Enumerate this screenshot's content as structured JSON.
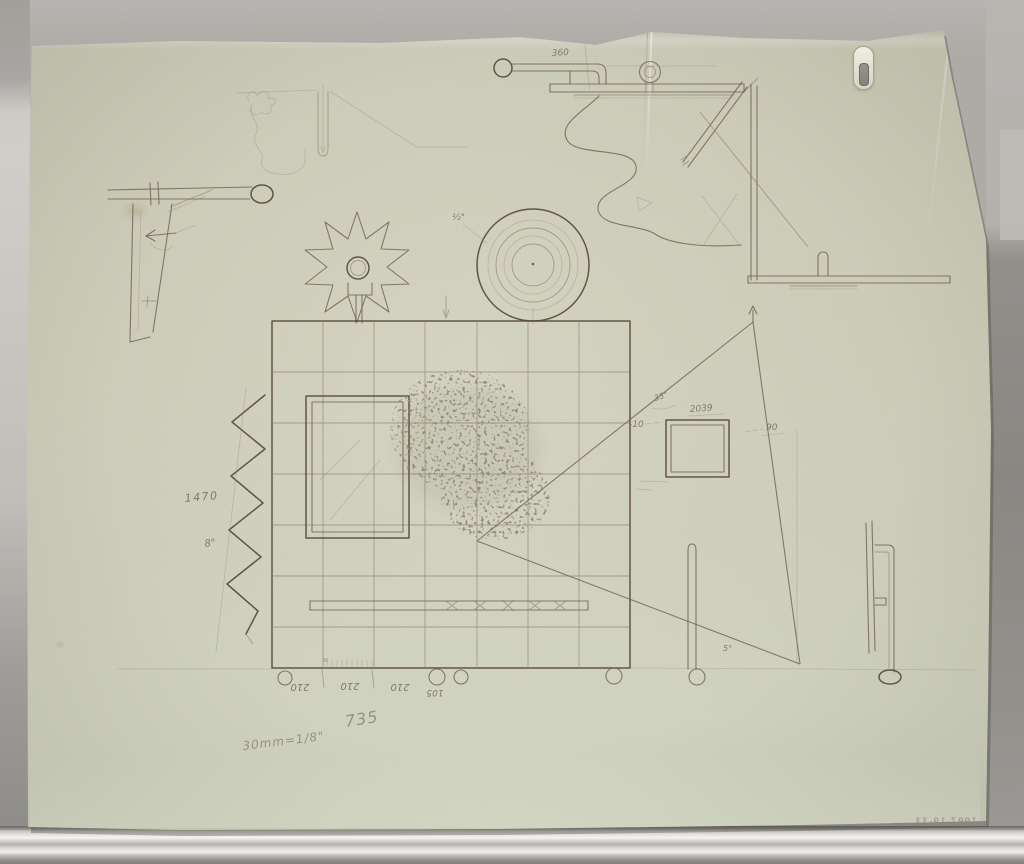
{
  "artwork": {
    "annotations": {
      "arm_length": "360",
      "disc_note": "½\"",
      "side_height": "1470",
      "side_angle": "8°",
      "fin_angle": "35°",
      "frame_dim": "2039",
      "frame_offset_left": "-10",
      "frame_offset_right": "90",
      "fin_base_angle": "5°",
      "base_seg_1": "210",
      "base_seg_2": "210",
      "base_seg_3": "210",
      "base_seg_4": "105",
      "overall_width": "735",
      "scale_note": "30mm=1/8\"",
      "accession_number": "1997-19-33"
    },
    "colors": {
      "paper": "#cfceba",
      "pencil_dark": "#544838",
      "pencil_mid": "#6e6050",
      "pencil_faint": "#857767",
      "graphite_script": "#8b8071",
      "backdrop": "#aeaba7",
      "mat_shadow": "#8a8783",
      "rail_highlight": "#f2f1ed"
    }
  }
}
